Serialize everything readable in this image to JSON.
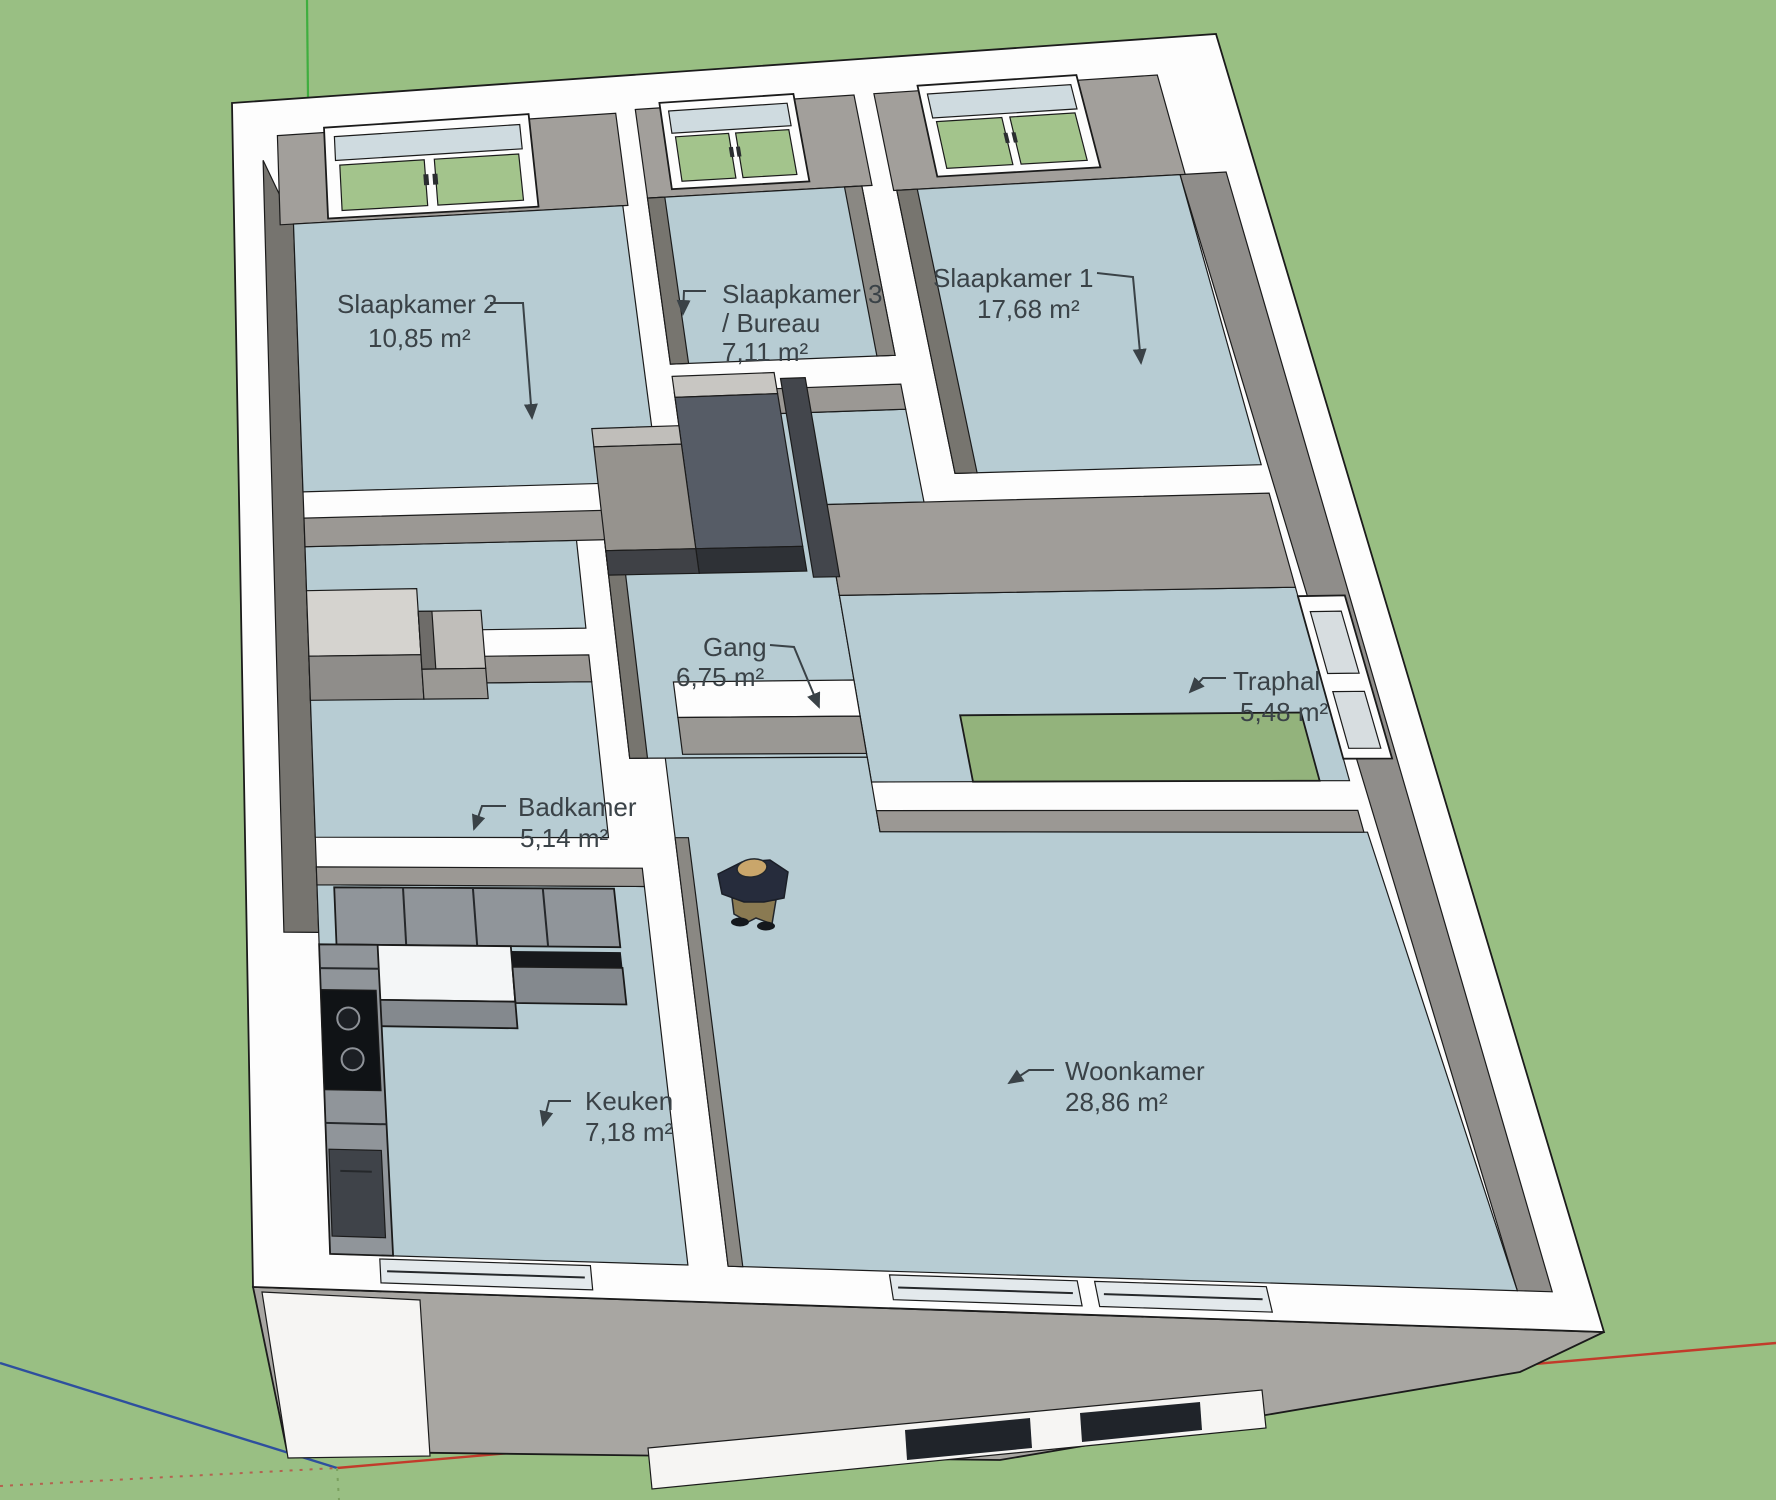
{
  "rooms": [
    {
      "id": "slaapkamer-2",
      "name": "Slaapkamer 2",
      "area": "10,85 m²"
    },
    {
      "id": "slaapkamer-3",
      "name": "Slaapkamer 3",
      "name2": "/ Bureau",
      "area": "7,11 m²"
    },
    {
      "id": "slaapkamer-1",
      "name": "Slaapkamer 1",
      "area": "17,68 m²"
    },
    {
      "id": "gang",
      "name": "Gang",
      "area": "6,75 m²"
    },
    {
      "id": "traphal",
      "name": "Traphal",
      "area": "5,48 m²"
    },
    {
      "id": "badkamer",
      "name": "Badkamer",
      "area": "5,14 m²"
    },
    {
      "id": "keuken",
      "name": "Keuken",
      "area": "7,18 m²"
    },
    {
      "id": "woonkamer",
      "name": "Woonkamer",
      "area": "28,86 m²"
    }
  ],
  "colors": {
    "background": "#99bf83",
    "floor": "#b7ccd3",
    "wall_top": "#fdfdfd",
    "wall_face_light": "#a29f9b",
    "wall_face_medium": "#8f8d8a",
    "wall_face_dark": "#76746f",
    "stair_opening": "#93b37c",
    "window_glass": "#a3c48c",
    "label_text": "#3a4247",
    "axis_red": "#c23b2b",
    "axis_green": "#3fae3f",
    "axis_blue": "#2e4f9e"
  }
}
